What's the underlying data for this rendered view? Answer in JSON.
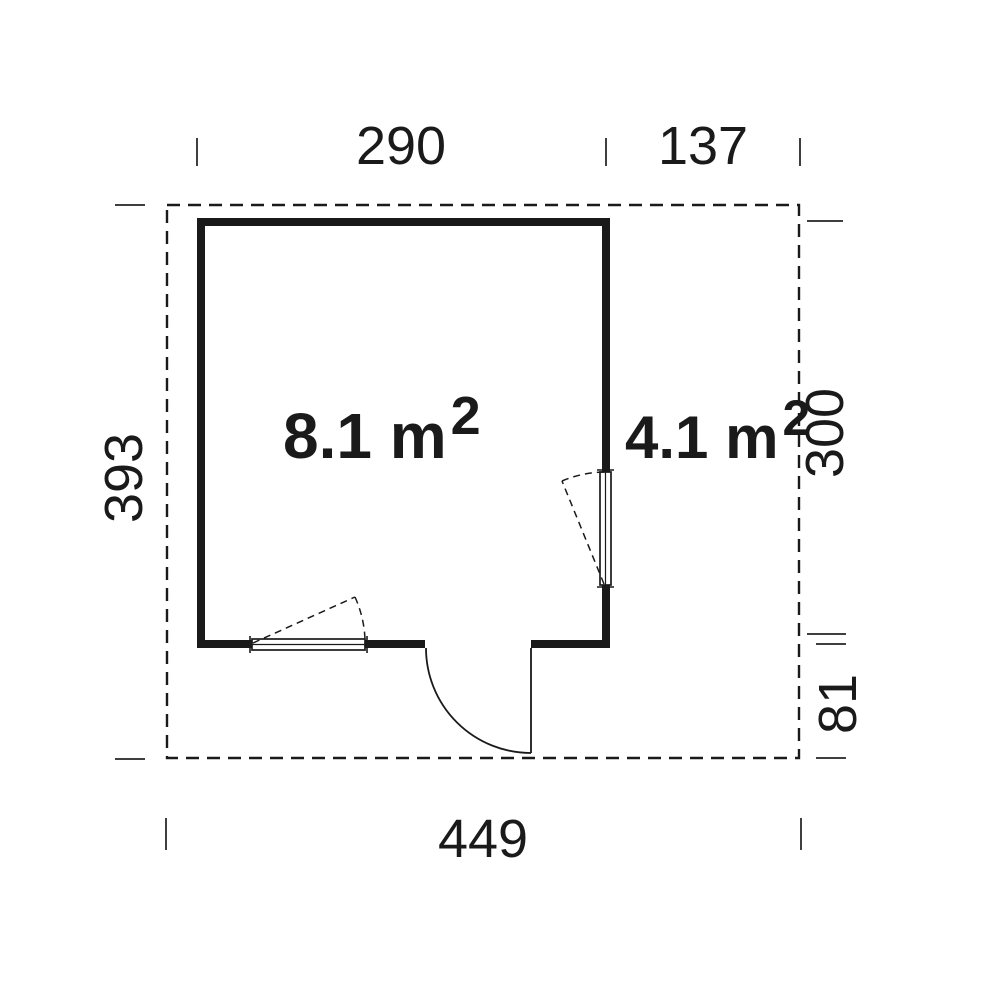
{
  "plan_type": "floor-plan",
  "colors": {
    "line": "#1a1a1a",
    "tick": "#3f3f3f",
    "bg": "#ffffff"
  },
  "dimensions": {
    "top_width_main": "290",
    "top_width_side": "137",
    "left_height_total": "393",
    "right_height_upper": "300",
    "right_height_lower": "81",
    "bottom_width_total": "449"
  },
  "rooms": {
    "main": {
      "area": "8.1 m",
      "sup": "2"
    },
    "side": {
      "area": "4.1 m",
      "sup": "2"
    }
  }
}
